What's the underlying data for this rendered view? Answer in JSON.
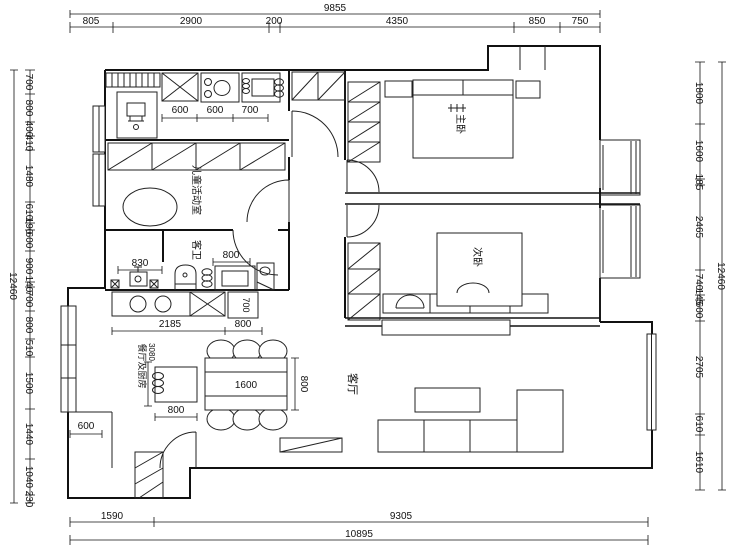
{
  "drawing": {
    "type": "apartment floor plan",
    "colors": {
      "line": "#111111",
      "background": "#ffffff"
    }
  },
  "rooms": {
    "master_bedroom": "主卧",
    "second_bedroom": "次卧",
    "children_room": "儿童活动室",
    "guest_bath": "客卫",
    "living_room": "客厅",
    "dining_kitchen": "餐厅及厨房"
  },
  "dimensions": {
    "top": {
      "total": "9855",
      "segments": [
        "805",
        "2900",
        "200",
        "4350",
        "850",
        "750"
      ]
    },
    "bottom": {
      "total": "10895",
      "segments": [
        "1590",
        "9305"
      ]
    },
    "left": {
      "total": "12460",
      "segments": [
        "700",
        "800",
        "400",
        "410",
        "1480",
        "610",
        "190",
        "600",
        "900",
        "140",
        "700",
        "800",
        "510",
        "1500",
        "1440",
        "1040",
        "230"
      ]
    },
    "right": {
      "total": "12460",
      "segments": [
        "1800",
        "1600",
        "185",
        "2465",
        "740",
        "145",
        "600",
        "2705",
        "610",
        "1610"
      ]
    },
    "interior": {
      "kitchen_unit_a": "600",
      "kitchen_unit_b": "600",
      "kitchen_unit_c": "700",
      "laundry_width": "830",
      "bath_unit": "800",
      "counter_run": "2185",
      "counter_end": "800",
      "tall_unit": "700",
      "table_length": "1600",
      "table_width": "800",
      "island_width": "800",
      "dining_width": "3080",
      "porch_width": "600"
    }
  }
}
